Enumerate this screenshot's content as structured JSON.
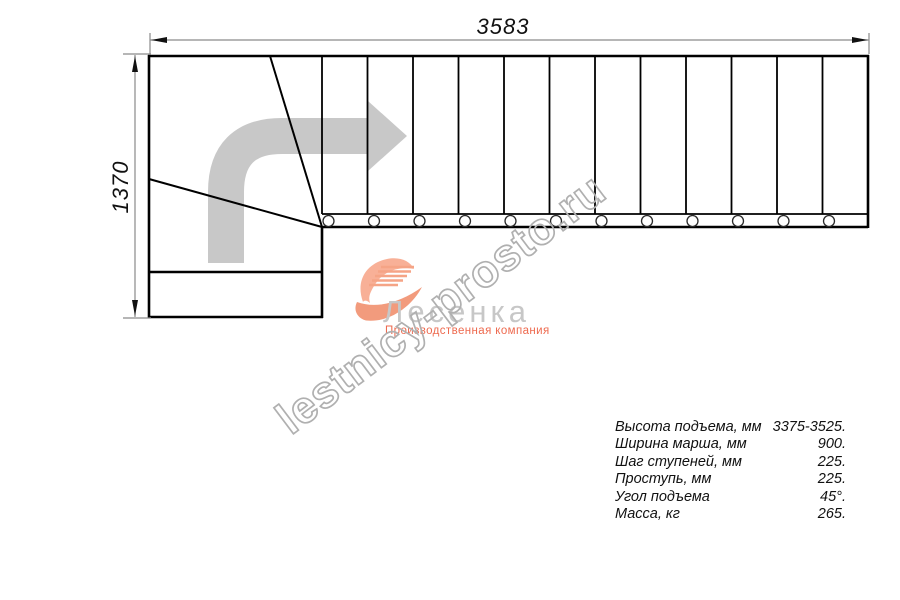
{
  "drawing": {
    "top_dimension": "3583",
    "left_dimension": "1370",
    "watermark": "lestnicy-prosto.ru"
  },
  "logo": {
    "name": "Лесенка",
    "subtitle": "Производственная компания"
  },
  "specs": {
    "rows": [
      {
        "label": "Высота подъема, мм",
        "value": "3375-3525."
      },
      {
        "label": "Ширина марша, мм",
        "value": "900."
      },
      {
        "label": "Шаг ступеней, мм",
        "value": "225."
      },
      {
        "label": "Проступь, мм",
        "value": "225."
      },
      {
        "label": "Угол подъема",
        "value": "45°."
      },
      {
        "label": "Масса, кг",
        "value": "265."
      }
    ]
  },
  "colors": {
    "line": "#000000",
    "dimension_line": "#8a8a8a",
    "direction_arrow": "#c8c8c8",
    "watermark": "#b0b0b0",
    "logo_text": "#c7c7c7",
    "logo_accent": "#ee6a4f",
    "logo_icon_light": "#f8b097",
    "logo_icon_dark": "#f29b7d"
  }
}
